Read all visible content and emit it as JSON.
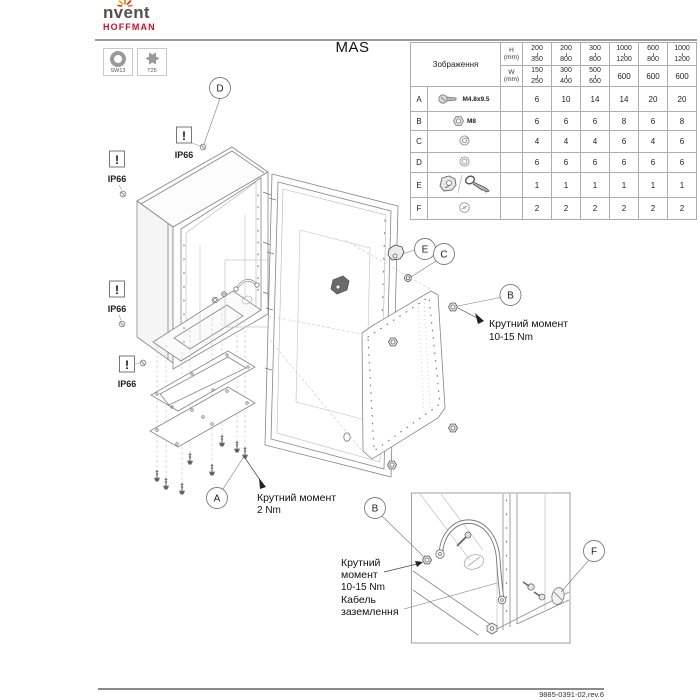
{
  "brand": {
    "name": "nvent",
    "sub": "HOFFMAN",
    "accent": "#c8102e",
    "spark_color": "#f26522"
  },
  "title": "MAS",
  "tools": [
    {
      "label": "SW13",
      "icon": "socket-wrench-icon"
    },
    {
      "label": "T25",
      "icon": "torx-bit-icon"
    }
  ],
  "table": {
    "image_col_header": "Зображення",
    "h_label": "H",
    "w_label": "W",
    "unit": "(mm)",
    "h_ranges": [
      [
        "200",
        "350"
      ],
      [
        "200",
        "800"
      ],
      [
        "300",
        "800"
      ],
      [
        "1000",
        "1200"
      ],
      [
        "600",
        "800"
      ],
      [
        "1000",
        "1200"
      ]
    ],
    "w_ranges": [
      [
        "150",
        "250"
      ],
      [
        "300",
        "400"
      ],
      [
        "500",
        "600"
      ],
      [
        "600"
      ],
      [
        "600"
      ],
      [
        "600"
      ]
    ],
    "rows": [
      {
        "letter": "A",
        "part_label": "M4.8x9.5",
        "icon": "screw-icon",
        "qty": [
          "6",
          "10",
          "14",
          "14",
          "20",
          "20"
        ]
      },
      {
        "letter": "B",
        "part_label": "M8",
        "icon": "nut-icon",
        "qty": [
          "6",
          "6",
          "6",
          "8",
          "6",
          "8"
        ]
      },
      {
        "letter": "C",
        "part_label": "",
        "icon": "lock-washer-icon",
        "qty": [
          "4",
          "4",
          "4",
          "6",
          "4",
          "6"
        ]
      },
      {
        "letter": "D",
        "part_label": "",
        "icon": "washer-icon",
        "qty": [
          "6",
          "6",
          "6",
          "6",
          "6",
          "6"
        ]
      },
      {
        "letter": "E",
        "part_label": "",
        "icon": "hinge-and-key-icon",
        "qty": [
          "1",
          "1",
          "1",
          "1",
          "1",
          "1"
        ]
      },
      {
        "letter": "F",
        "part_label": "",
        "icon": "plug-icon",
        "qty": [
          "2",
          "2",
          "2",
          "2",
          "2",
          "2"
        ]
      }
    ]
  },
  "callouts": {
    "a": "A",
    "b": "B",
    "c": "C",
    "d": "D",
    "e": "E",
    "f": "F",
    "b_inset": "B",
    "f_inset": "F"
  },
  "labels": {
    "ip66": "IP66",
    "warning": "!"
  },
  "annotations": {
    "torque_b_line1": "Крутний момент",
    "torque_b_line2": "10-15 Nm",
    "torque_a_line1": "Крутний момент",
    "torque_a_line2": "2 Nm",
    "inset_torque_line1": "Крутний",
    "inset_torque_line2": "момент",
    "inset_torque_line3": "10-15 Nm",
    "ground_line1": "Кабель",
    "ground_line2": "заземлення"
  },
  "footer": {
    "doc_number": "9885-0391-02,rev.6"
  }
}
